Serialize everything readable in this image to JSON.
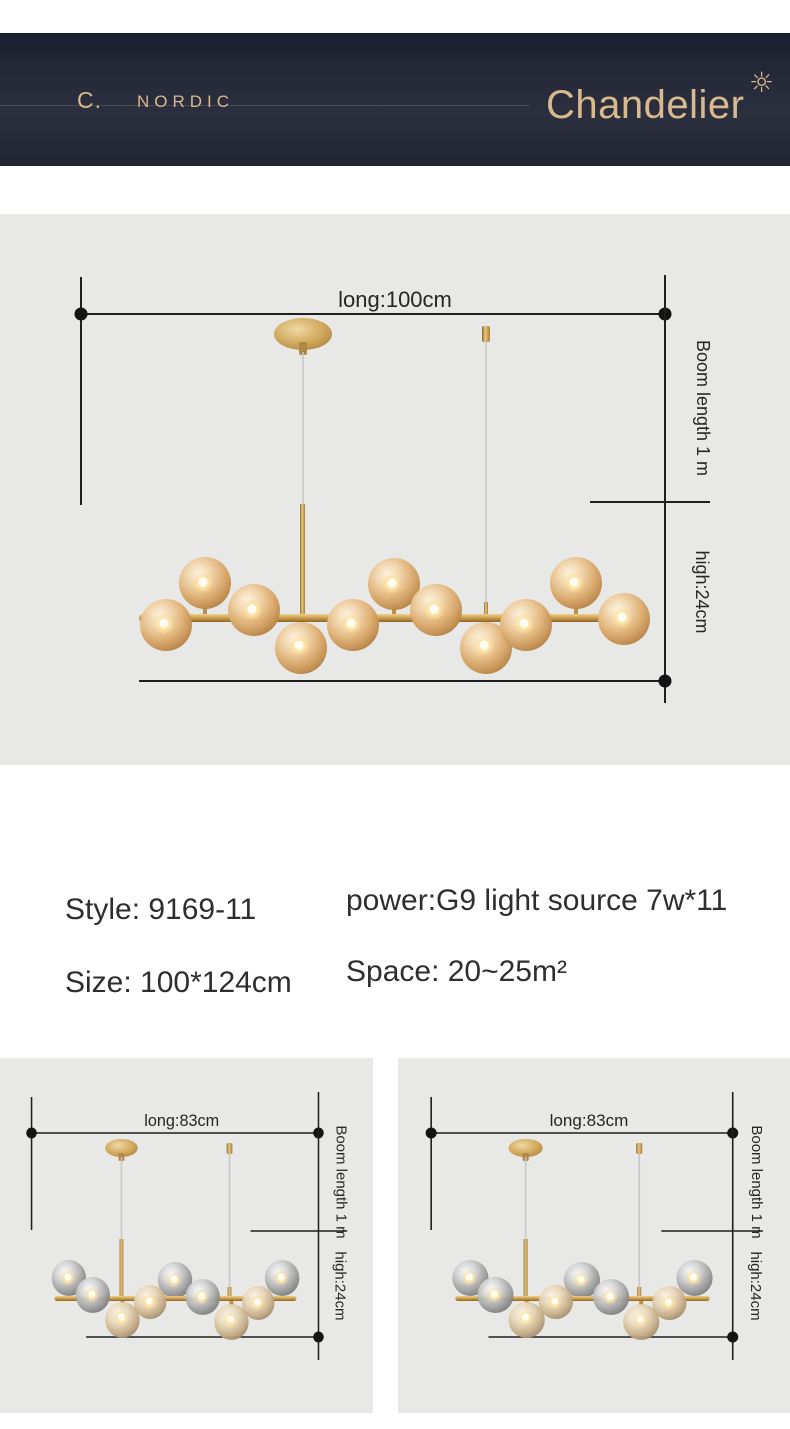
{
  "header": {
    "brand_initial": "C.",
    "brand_name": "NORDIC",
    "logo_text": "Chandelier",
    "sun_icon": "☼"
  },
  "main_diagram": {
    "long_label": "long:100cm",
    "boom_label": "Boom length 1 m",
    "high_label": "high:24cm"
  },
  "specs": {
    "style": "Style: 9169-11",
    "size": "Size: 100*124cm",
    "power": "power:G9 light source 7w*11",
    "space": "Space: 20~25m²"
  },
  "variants": {
    "left": {
      "long_label": "long:83cm",
      "boom_label": "Boom length 1 m",
      "high_label": "high:24cm"
    },
    "right": {
      "long_label": "long:83cm",
      "boom_label": "Boom length 1 m",
      "high_label": "high:24cm"
    }
  },
  "colors": {
    "header_bg": "#252938",
    "gold": "#d9b98e",
    "panel_bg": "#e8e8e6",
    "dimension_line": "#1f1f1f",
    "spec_text": "#2e2e2e"
  }
}
